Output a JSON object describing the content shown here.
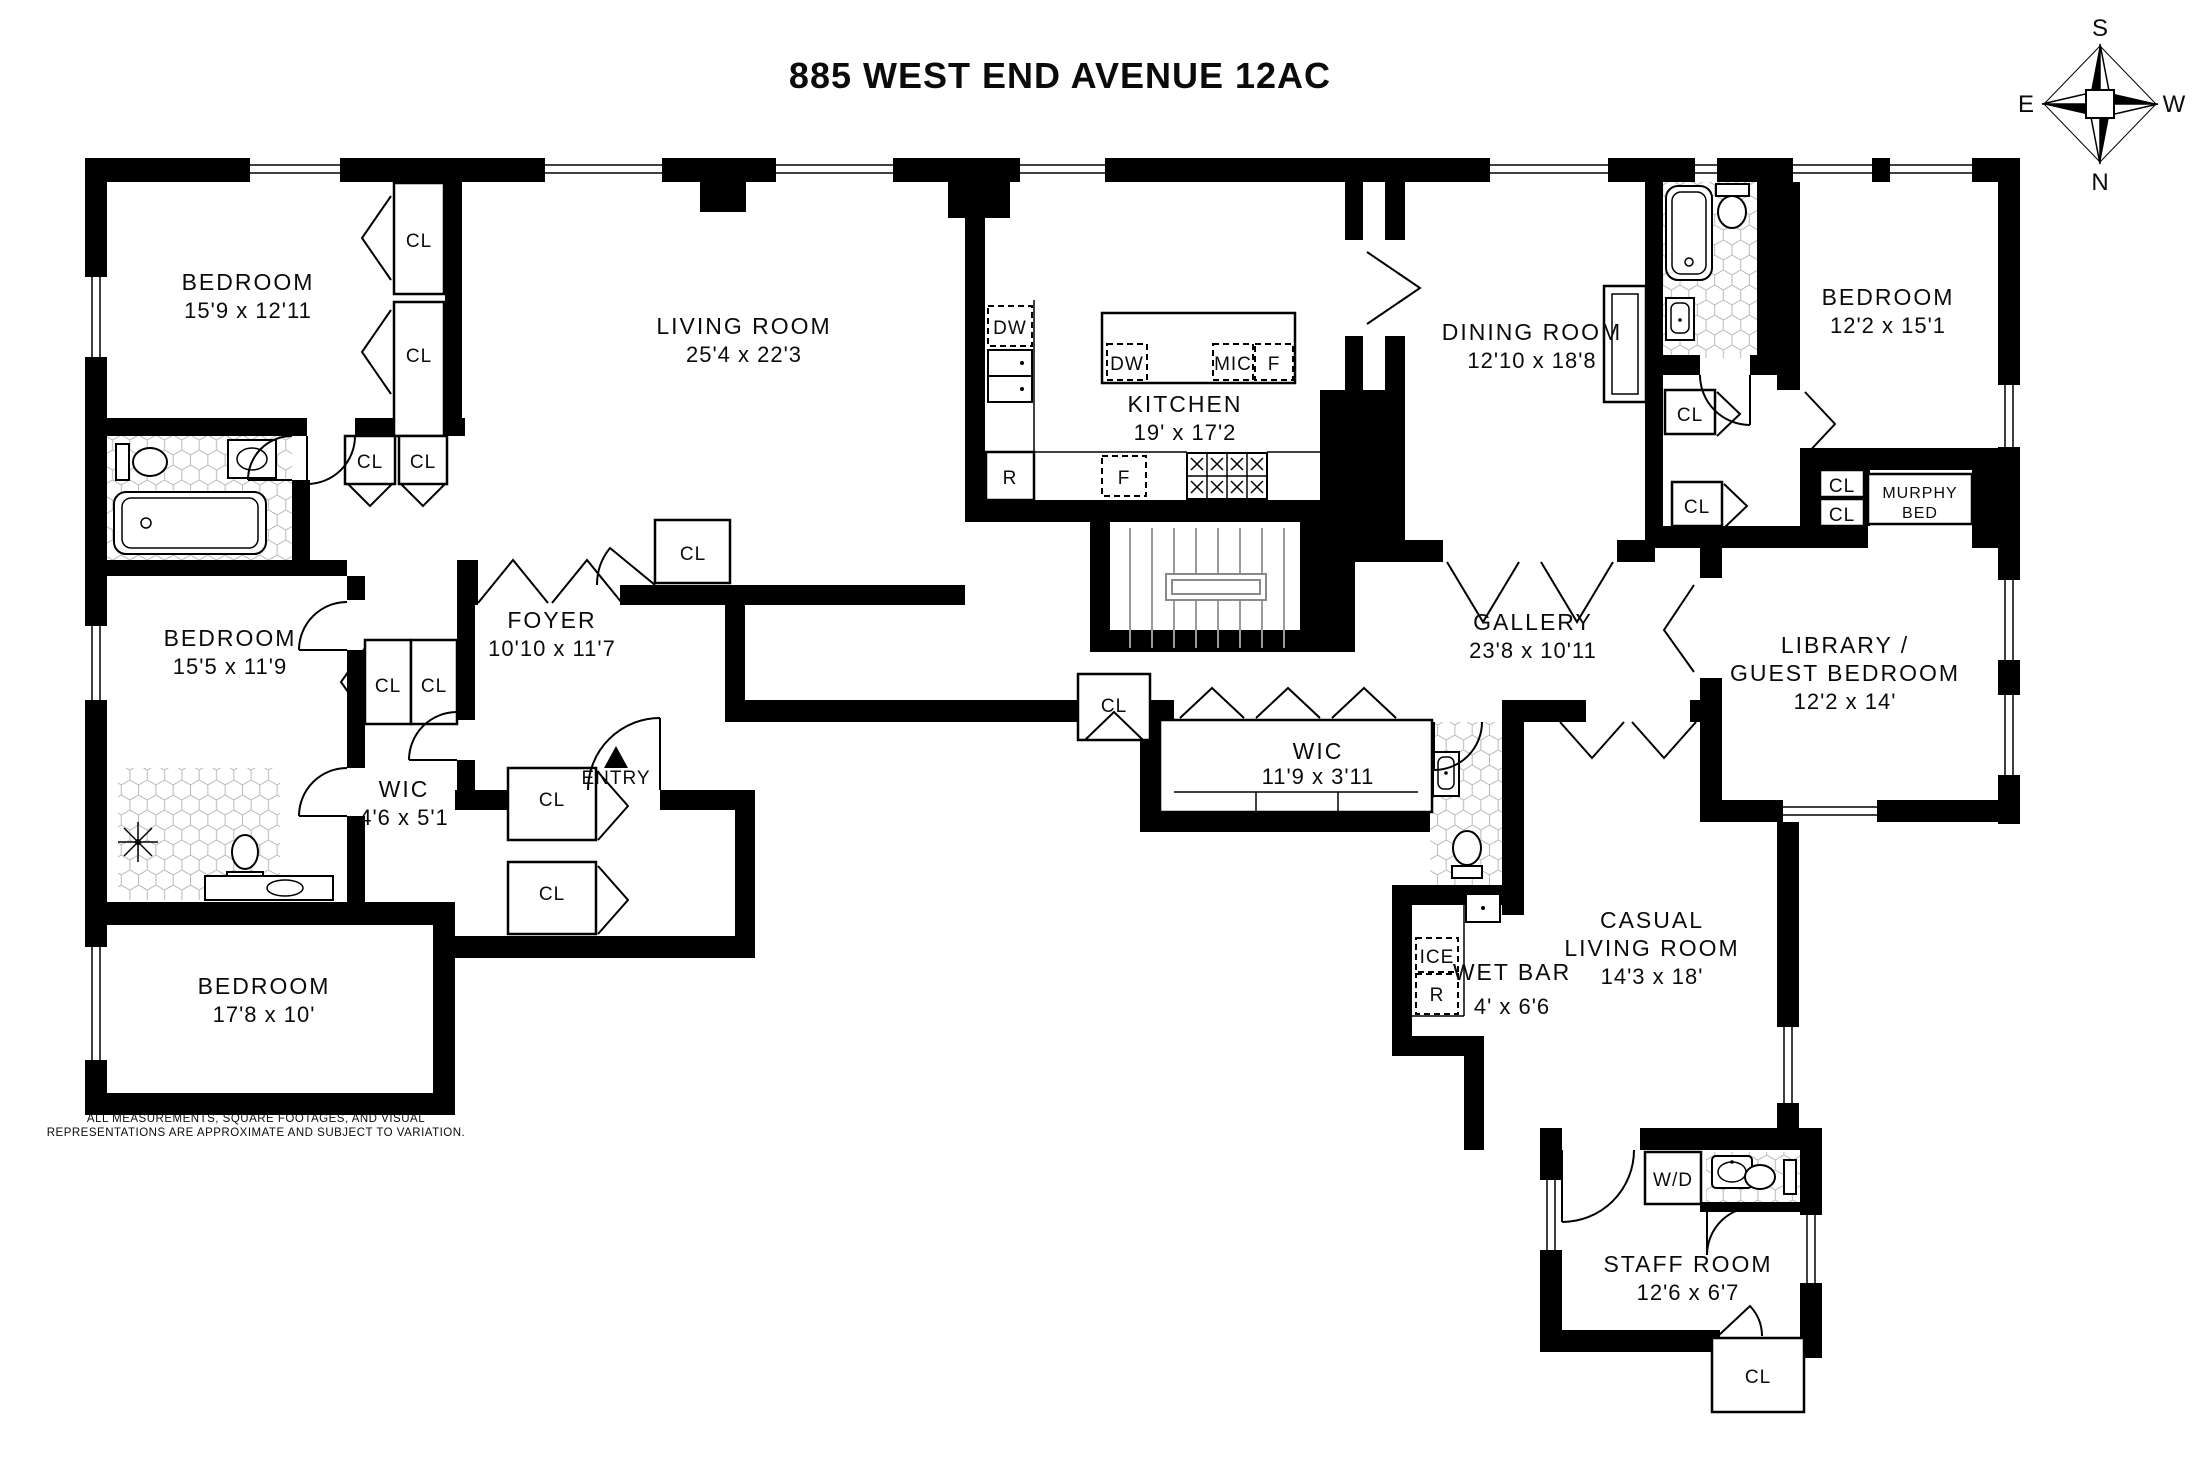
{
  "title": "885 WEST END AVENUE 12AC",
  "compass": {
    "top": "S",
    "bottom": "N",
    "left": "E",
    "right": "W"
  },
  "rooms": {
    "bedroom_tl": {
      "name": "BEDROOM",
      "dims": "15'9 x 12'11"
    },
    "bedroom_ml": {
      "name": "BEDROOM",
      "dims": "15'5 x 11'9"
    },
    "bedroom_bl": {
      "name": "BEDROOM",
      "dims": "17'8 x 10'"
    },
    "bedroom_tr": {
      "name": "BEDROOM",
      "dims": "12'2 x 15'1"
    },
    "living_room": {
      "name": "LIVING ROOM",
      "dims": "25'4 x 22'3"
    },
    "kitchen": {
      "name": "KITCHEN",
      "dims": "19' x 17'2"
    },
    "dining_room": {
      "name": "DINING ROOM",
      "dims": "12'10 x 18'8"
    },
    "foyer": {
      "name": "FOYER",
      "dims": "10'10 x 11'7"
    },
    "gallery": {
      "name": "GALLERY",
      "dims": "23'8 x 10'11"
    },
    "library": {
      "name_line1": "LIBRARY /",
      "name_line2": "GUEST BEDROOM",
      "dims": "12'2 x 14'"
    },
    "wic_small": {
      "name": "WIC",
      "dims": "4'6 x 5'1"
    },
    "wic_long": {
      "name": "WIC",
      "dims": "11'9 x 3'11"
    },
    "wet_bar": {
      "name": "WET BAR",
      "dims": "4' x 6'6"
    },
    "casual_living": {
      "name_line1": "CASUAL",
      "name_line2": "LIVING ROOM",
      "dims": "14'3 x 18'"
    },
    "staff_room": {
      "name": "STAFF ROOM",
      "dims": "12'6 x 6'7"
    }
  },
  "labels": {
    "closet": "CL",
    "entry": "ENTRY",
    "murphy_line1": "MURPHY",
    "murphy_line2": "BED",
    "dishwasher": "DW",
    "microwave": "MIC",
    "refrigerator": "F",
    "range": "R",
    "ice": "ICE",
    "washer_dryer": "W/D"
  },
  "disclaimer": {
    "line1": "ALL MEASUREMENTS, SQUARE FOOTAGES, AND VISUAL",
    "line2": "REPRESENTATIONS ARE APPROXIMATE AND SUBJECT TO VARIATION."
  }
}
